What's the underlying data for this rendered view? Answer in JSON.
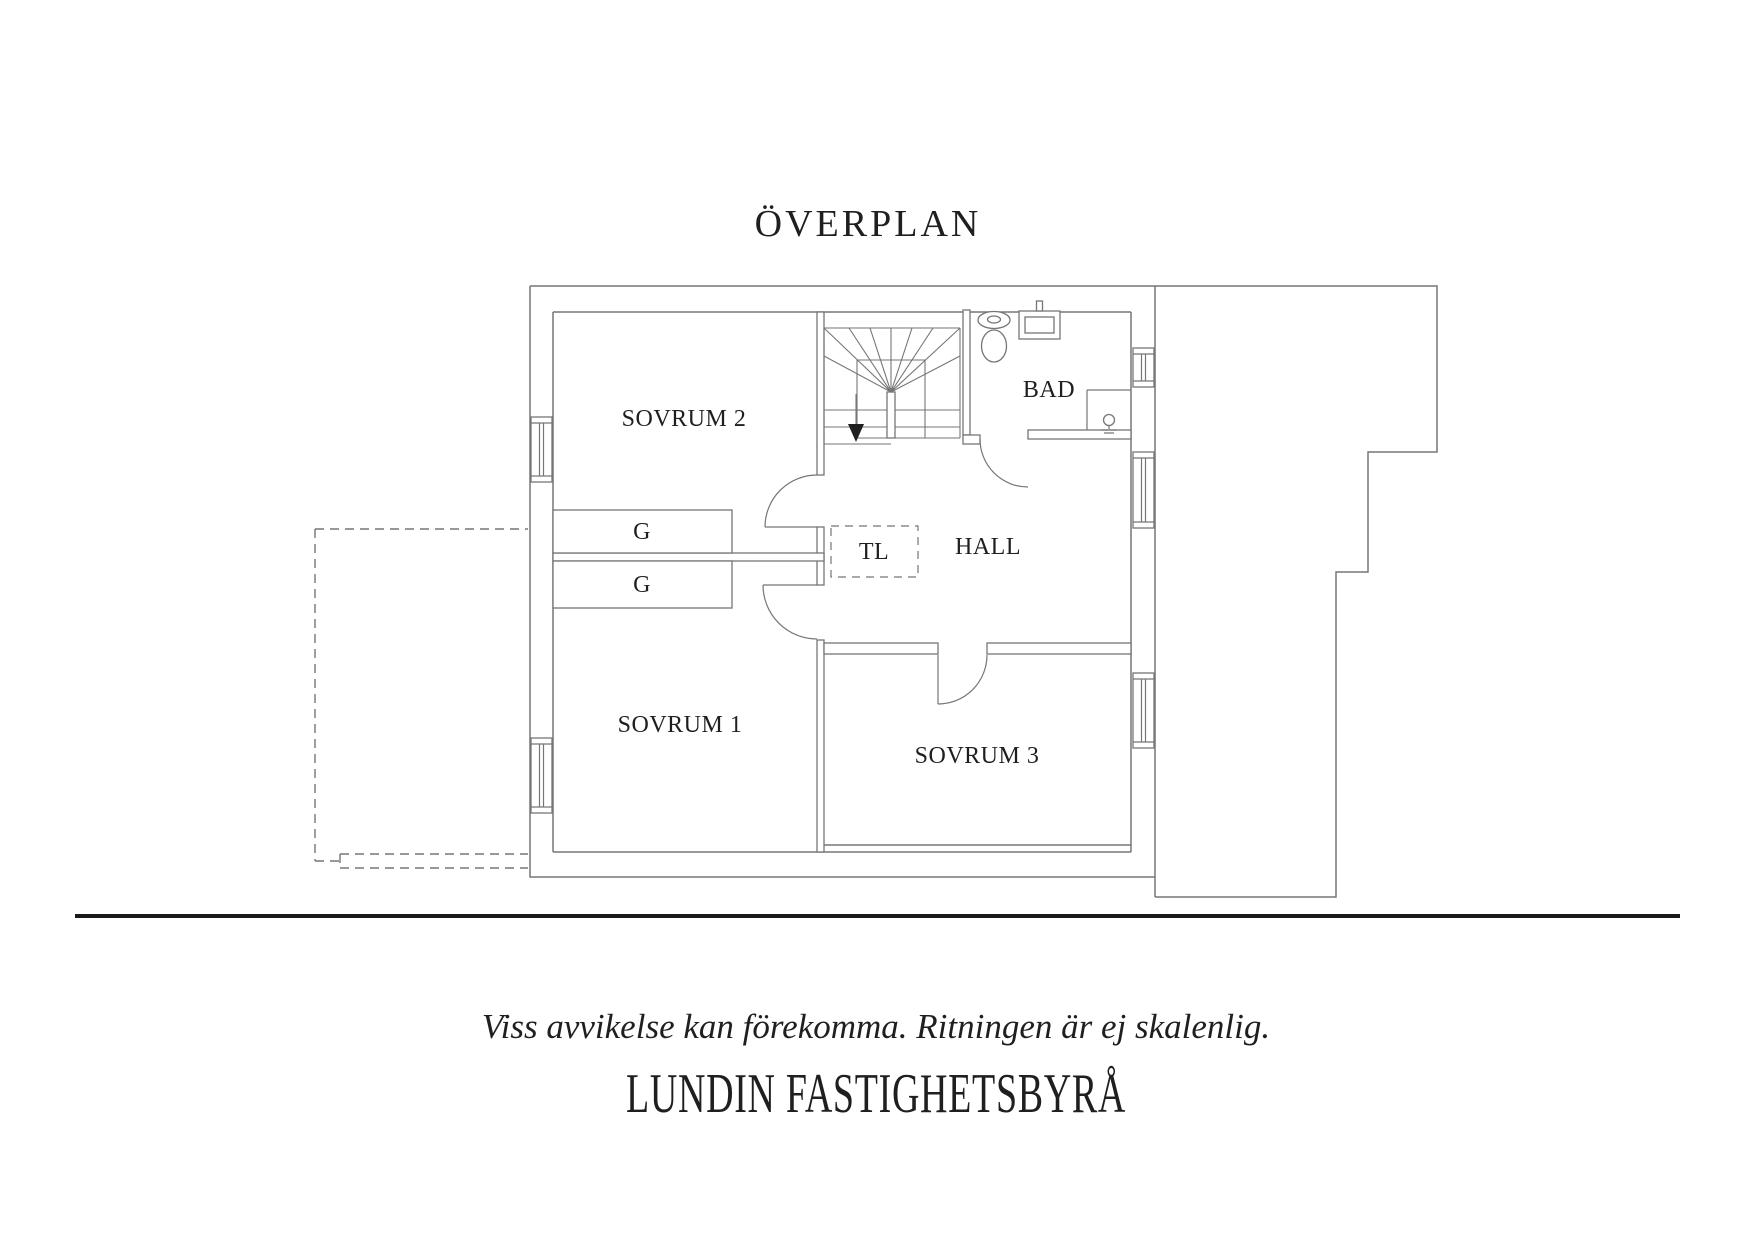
{
  "title": "ÖVERPLAN",
  "plan": {
    "rooms": [
      {
        "id": "sovrum2",
        "label": "SOVRUM 2"
      },
      {
        "id": "sovrum1",
        "label": "SOVRUM 1"
      },
      {
        "id": "sovrum3",
        "label": "SOVRUM 3"
      },
      {
        "id": "bad",
        "label": "BAD"
      },
      {
        "id": "hall",
        "label": "HALL"
      }
    ],
    "annotations": [
      {
        "id": "tl",
        "label": "TL"
      },
      {
        "id": "g_top",
        "label": "G"
      },
      {
        "id": "g_bottom",
        "label": "G"
      }
    ],
    "stair_direction": "down"
  },
  "footer": {
    "disclaimer": "Viss avvikelse kan förekomma. Ritningen är ej skalenlig.",
    "agency": "LUNDIN FASTIGHETSBYRÅ"
  },
  "colors": {
    "wall": "#767676",
    "text": "#1f1f1f",
    "separator": "#1a1a1a",
    "background": "#ffffff"
  }
}
